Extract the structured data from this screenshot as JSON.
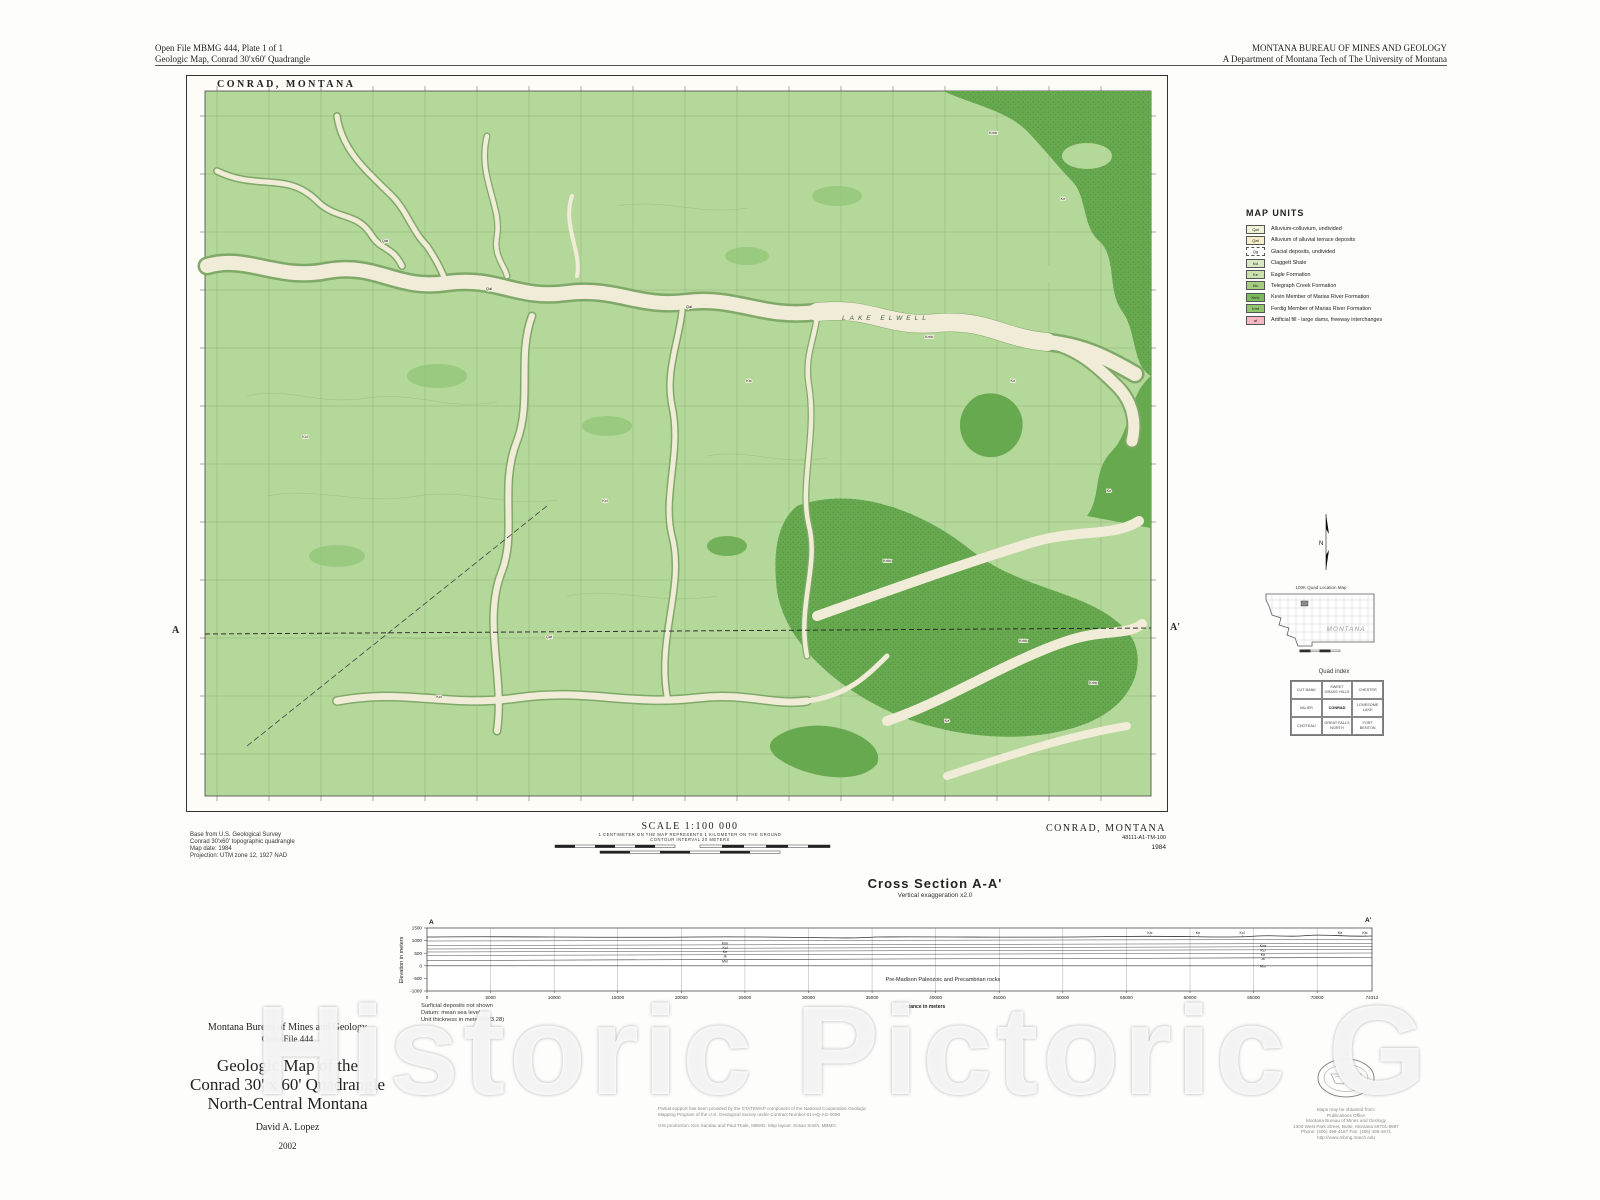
{
  "page": {
    "header_left_line1": "Open File MBMG 444, Plate 1 of 1",
    "header_left_line2": "Geologic Map, Conrad 30'x60' Quadrangle",
    "header_right_line1": "MONTANA BUREAU OF MINES AND GEOLOGY",
    "header_right_line2": "A Department of Montana Tech of The University of Montana",
    "watermark": "Historic Pictoric G"
  },
  "map": {
    "title": "CONRAD,  MONTANA",
    "lake_label": "LAKE ELWELL",
    "section_a": "A",
    "section_a_prime": "A'",
    "base_credit": [
      "Base from U.S. Geological Survey",
      "Conrad 30'x60' topographic quadrangle",
      "Map date: 1984",
      "Projection: UTM zone 12, 1927 NAD"
    ],
    "scale": {
      "title": "SCALE 1:100 000",
      "note1": "1 CENTIMETER ON THE MAP REPRESENTS 1 KILOMETER ON THE GROUND",
      "note2": "CONTOUR INTERVAL 20 METERS"
    },
    "corner": {
      "name": "CONRAD, MONTANA",
      "id": "48111-A1-TM-100",
      "year": "1984"
    },
    "colors": {
      "map_green": "#b4d79a",
      "dark_green": "#67a94f",
      "valley_cream": "#f1ecd7"
    },
    "unit_labels": [
      {
        "c": "Kmk",
        "x": 806,
        "y": 58
      },
      {
        "c": "Ke",
        "x": 876,
        "y": 124
      },
      {
        "c": "Kmk",
        "x": 742,
        "y": 262
      },
      {
        "c": "Ke",
        "x": 826,
        "y": 306
      },
      {
        "c": "Kmk",
        "x": 700,
        "y": 486
      },
      {
        "c": "Kmk",
        "x": 836,
        "y": 566
      },
      {
        "c": "Ke",
        "x": 760,
        "y": 646
      },
      {
        "c": "Qal",
        "x": 302,
        "y": 214
      },
      {
        "c": "Qat",
        "x": 198,
        "y": 166
      },
      {
        "c": "Kcl",
        "x": 118,
        "y": 362
      },
      {
        "c": "Kcl",
        "x": 418,
        "y": 426
      },
      {
        "c": "Ktc",
        "x": 562,
        "y": 306
      },
      {
        "c": "Qal",
        "x": 502,
        "y": 232
      },
      {
        "c": "Qat",
        "x": 362,
        "y": 562
      },
      {
        "c": "Kcl",
        "x": 252,
        "y": 622
      },
      {
        "c": "Ke",
        "x": 922,
        "y": 416
      },
      {
        "c": "Kmk",
        "x": 906,
        "y": 608
      }
    ]
  },
  "legend": {
    "title": "MAP UNITS",
    "items": [
      {
        "code": "Qal",
        "label": "Alluvium-colluvium, undivided",
        "color": "#eff2d8"
      },
      {
        "code": "Qat",
        "label": "Alluvium of alluvial terrace deposits",
        "color": "#f4eecb"
      },
      {
        "code": "Qg",
        "label": "Glacial deposits, undivided",
        "color": "#ffffff",
        "dashed": true
      },
      {
        "code": "Kcl",
        "label": "Claggett Shale",
        "color": "#d9e8c3"
      },
      {
        "code": "Ke",
        "label": "Eagle Formation",
        "color": "#cbe2ad"
      },
      {
        "code": "Ktc",
        "label": "Telegraph Creek Formation",
        "color": "#a4cd80"
      },
      {
        "code": "Kmk",
        "label": "Kevin Member of Marias River Formation",
        "color": "#7db95e"
      },
      {
        "code": "Kmf",
        "label": "Ferdig Member of Marias River Formation",
        "color": "#93c56f"
      },
      {
        "code": "af",
        "label": "Artificial fill - large dams, freeway interchanges",
        "color": "#f5b8c3"
      }
    ]
  },
  "sidebar": {
    "north_label": "N",
    "location_map_title": "100K Quad Location Map",
    "state_label": "MONTANA",
    "quad_index_title": "Quad index",
    "quad_index": [
      [
        "CUT BANK",
        "SWEET GRASS HILLS",
        "CHESTER"
      ],
      [
        "VALIER",
        "CONRAD",
        "LONESOME LAKE"
      ],
      [
        "CHOTEAU",
        "GREAT FALLS NORTH",
        "FORT BENTON"
      ]
    ]
  },
  "cross_section": {
    "title": "Cross Section A-A'",
    "subtitle": "Vertical exaggeration x2.0",
    "ylabel": "Elevation in meters",
    "xlabel": "Distance in meters",
    "y_ticks": [
      "1500",
      "1000",
      "500",
      "0",
      "-500",
      "-1000"
    ],
    "x_ticks": [
      "0",
      "5000",
      "10000",
      "15000",
      "20000",
      "25000",
      "30000",
      "35000",
      "40000",
      "45000",
      "50000",
      "55000",
      "60000",
      "65000",
      "70000"
    ],
    "x_end": "74312",
    "end_labels": {
      "a": "A",
      "a_prime": "A'"
    },
    "basement_label": "Pre-Madison Paleozoic and Precambrian rocks",
    "left_stack_labels": [
      "Kmr",
      "Kcl",
      "Ke",
      "Jk",
      "Mm"
    ],
    "right_stack_labels": [
      "Kmr",
      "Kcl",
      "Ke",
      "Jk",
      "Mm"
    ],
    "surface_labels": [
      "Ktc",
      "Ke",
      "Kcl",
      "Ke",
      "Ktc"
    ],
    "notes": [
      "Surficial deposits not shown",
      "Datum: mean sea level",
      "Unit thickness in meters (ft/3.28)"
    ]
  },
  "title_block": {
    "org": "Montana Bureau of Mines and Geology",
    "open_file": "Open File 444",
    "line1": "Geologic Map of the",
    "line2": "Conrad 30' x 60' Quadrangle",
    "line3": "North-Central Montana",
    "author": "David A. Lopez",
    "year": "2002"
  },
  "credits": {
    "line1": "Partial support has been provided by the STATEMAP component of the National Cooperative Geologic",
    "line2": "Mapping Program of the U.S. Geological Survey under Contract Number 01-HQ-AG-0096",
    "gis": "GIS production: Ken Sandau and Paul Thale, MBMG. Map layout: Susan Smith, MBMG."
  },
  "publisher": {
    "lines": [
      "Maps may be obtained from:",
      "Publications Office",
      "Montana Bureau of Mines and Geology",
      "1300 West Park Street, Butte, Montana 59701-8997",
      "Phone: (406) 496-4167      Fax: (406) 496-4671",
      "http://www.mbmg.mtech.edu"
    ]
  }
}
